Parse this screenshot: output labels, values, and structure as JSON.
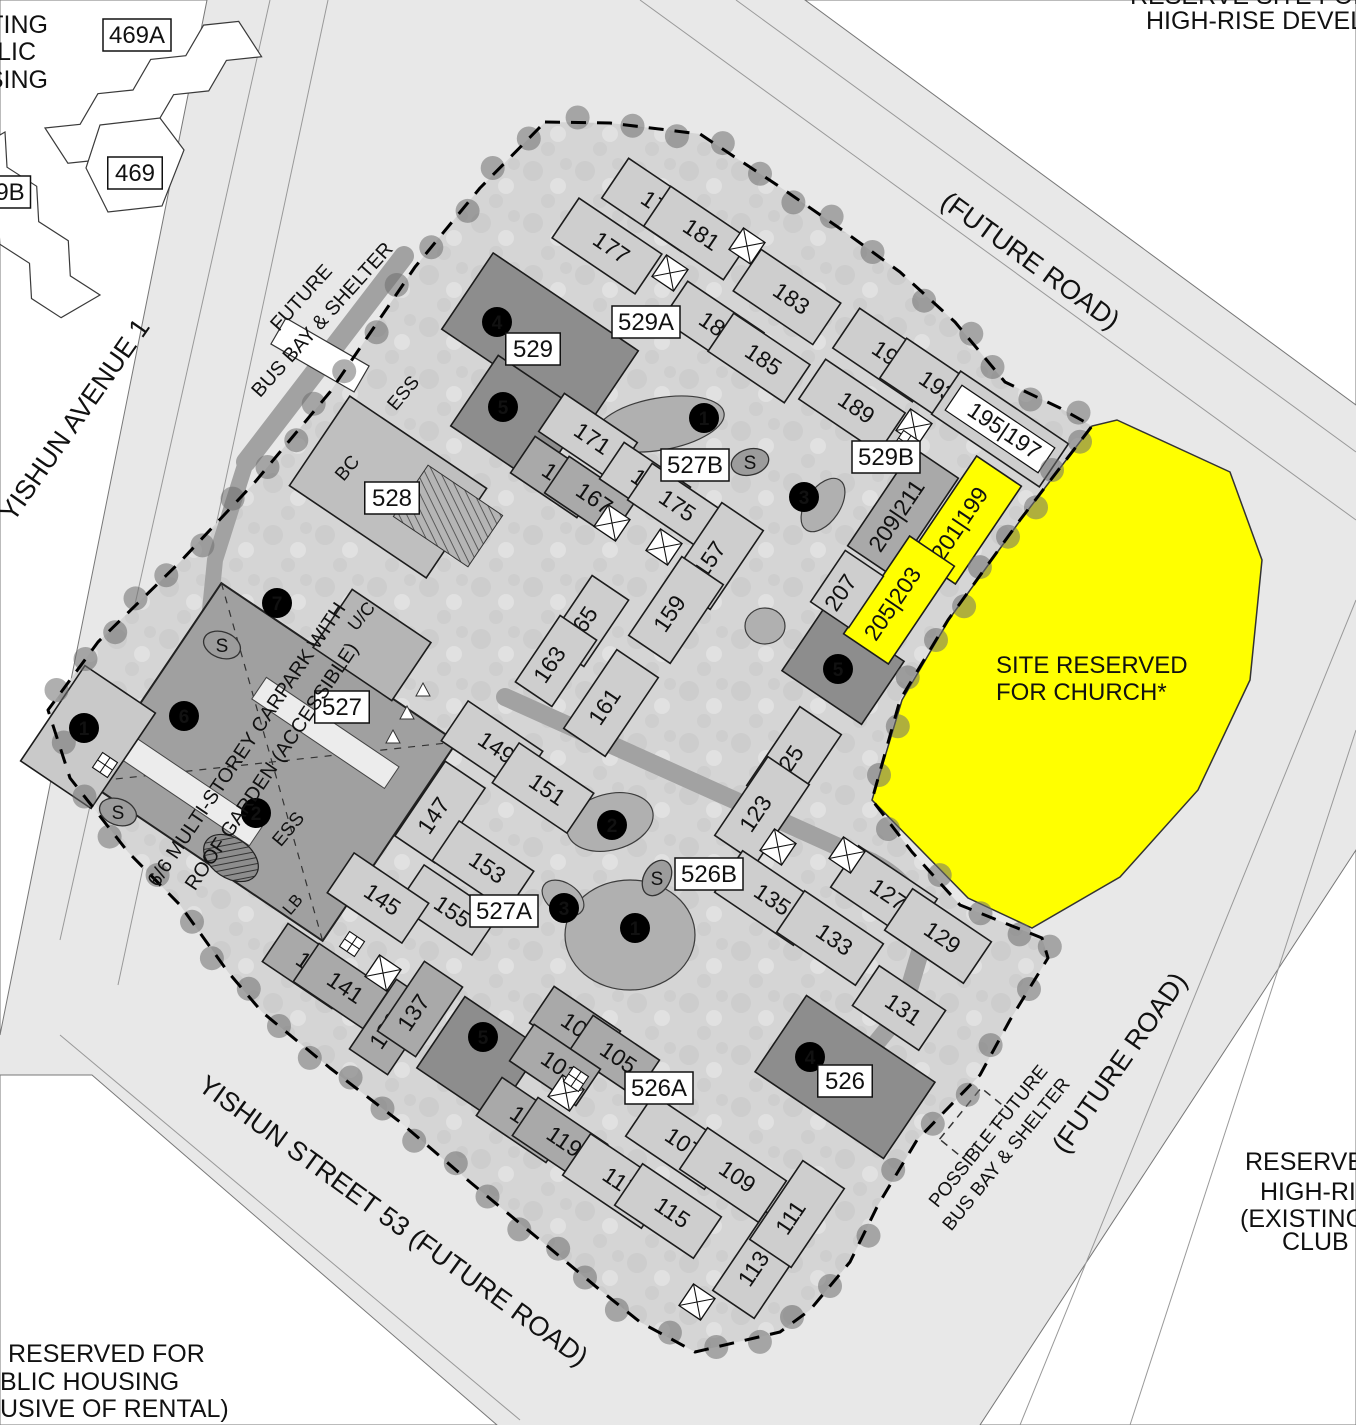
{
  "map": {
    "corner_texts": {
      "top_left_lines": [
        "TING",
        "LIC",
        "SING"
      ],
      "top_right_line1": "RESERVE SITE FOR",
      "top_right_line2": "HIGH-RISE DEVELO",
      "bottom_left_lines": [
        "RESERVED FOR",
        "BLIC HOUSING",
        "USIVE OF RENTAL)"
      ],
      "bottom_right_lines": [
        "RESERVE",
        "HIGH-RIS",
        "(EXISTING",
        "CLUB G"
      ]
    },
    "church": {
      "line1": "SITE RESERVED",
      "line2": "FOR CHURCH*"
    },
    "colors": {
      "road": "#e8e8e8",
      "site": "#d5d5d5",
      "inner_road": "#a2a2a2",
      "building_light": "#cecece",
      "building_mid": "#a9a9a9",
      "building_dark": "#8d8d8d",
      "carpark": "#a0a0a0",
      "block528": "#bfbfbf",
      "uc": "#b5b5b5",
      "yellow": "#ffff00",
      "tree": "rgba(110,110,110,0.55)",
      "grass": "#b0b0b0"
    },
    "road_labels": [
      {
        "text": "YISHUN AVENUE 1",
        "x": 82,
        "y": 425,
        "rot": -55,
        "size": 27
      },
      {
        "text": "(FUTURE ROAD)",
        "x": 1025,
        "y": 268,
        "rot": 36,
        "size": 27
      },
      {
        "text": "(FUTURE ROAD)",
        "x": 1127,
        "y": 1068,
        "rot": -55,
        "size": 27
      },
      {
        "text": "YISHUN STREET 53 (FUTURE ROAD)",
        "x": 388,
        "y": 1228,
        "rot": 36,
        "size": 27
      },
      {
        "text": "FUTURE",
        "x": 306,
        "y": 302,
        "rot": -48,
        "size": 20
      },
      {
        "text": "BUS BAY & SHELTER",
        "x": 327,
        "y": 324,
        "rot": -48,
        "size": 20
      },
      {
        "text": "POSSIBLE FUTURE",
        "x": 993,
        "y": 1140,
        "rot": -51,
        "size": 19
      },
      {
        "text": "BUS BAY & SHELTER",
        "x": 1011,
        "y": 1158,
        "rot": -51,
        "size": 19
      }
    ],
    "site_texts": [
      {
        "text": "6/6 MULTI-STOREY CARPARK WITH",
        "x": 252,
        "y": 748,
        "rot": -56,
        "size": 20
      },
      {
        "text": "ROOF GARDEN (ACCESSIBLE)",
        "x": 277,
        "y": 770,
        "rot": -56,
        "size": 20
      },
      {
        "text": "ESS",
        "x": 408,
        "y": 397,
        "rot": -50,
        "size": 19
      },
      {
        "text": "ESS",
        "x": 293,
        "y": 833,
        "rot": -50,
        "size": 19
      },
      {
        "text": "BC",
        "x": 352,
        "y": 472,
        "rot": -50,
        "size": 19
      },
      {
        "text": "U/C",
        "x": 366,
        "y": 620,
        "rot": -50,
        "size": 18
      },
      {
        "text": "LB",
        "x": 297,
        "y": 908,
        "rot": -50,
        "size": 17
      }
    ],
    "boxed_labels": [
      {
        "text": "529A",
        "x": 646,
        "y": 322
      },
      {
        "text": "529B",
        "x": 886,
        "y": 457
      },
      {
        "text": "527B",
        "x": 695,
        "y": 465
      },
      {
        "text": "527A",
        "x": 504,
        "y": 911
      },
      {
        "text": "526A",
        "x": 659,
        "y": 1088
      },
      {
        "text": "526B",
        "x": 709,
        "y": 874
      },
      {
        "text": "527",
        "x": 342,
        "y": 707
      },
      {
        "text": "528",
        "x": 392,
        "y": 498
      },
      {
        "text": "529",
        "x": 533,
        "y": 349
      },
      {
        "text": "526",
        "x": 845,
        "y": 1081
      },
      {
        "text": "469A",
        "x": 137,
        "y": 35
      },
      {
        "text": "469",
        "x": 135,
        "y": 173
      },
      {
        "text": "9B",
        "x": 10,
        "y": 192
      }
    ],
    "buildings": [
      {
        "n": "177",
        "x": 607,
        "y": 246,
        "w": 100,
        "h": 48,
        "rot": 34,
        "fill": "light"
      },
      {
        "n": "179",
        "x": 655,
        "y": 205,
        "w": 96,
        "h": 48,
        "rot": 34,
        "fill": "light"
      },
      {
        "n": "181",
        "x": 697,
        "y": 233,
        "w": 96,
        "h": 48,
        "rot": 34,
        "fill": "light"
      },
      {
        "n": "183",
        "x": 787,
        "y": 297,
        "w": 96,
        "h": 50,
        "rot": 34,
        "fill": "light"
      },
      {
        "n": "187",
        "x": 713,
        "y": 326,
        "w": 92,
        "h": 46,
        "rot": 34,
        "fill": "light"
      },
      {
        "n": "185",
        "x": 759,
        "y": 358,
        "w": 92,
        "h": 46,
        "rot": 34,
        "fill": "light"
      },
      {
        "n": "189",
        "x": 852,
        "y": 406,
        "w": 96,
        "h": 48,
        "rot": 34,
        "fill": "light"
      },
      {
        "n": "191",
        "x": 886,
        "y": 355,
        "w": 96,
        "h": 48,
        "rot": 34,
        "fill": "light"
      },
      {
        "n": "193",
        "x": 933,
        "y": 385,
        "w": 96,
        "h": 48,
        "rot": 34,
        "fill": "light"
      },
      {
        "n": "195|197",
        "x": 1000,
        "y": 429,
        "w": 130,
        "h": 52,
        "rot": 34,
        "fill": "light",
        "boxed": true
      },
      {
        "n": "209|211",
        "x": 903,
        "y": 512,
        "w": 118,
        "h": 54,
        "rot": -56,
        "fill": "mid"
      },
      {
        "n": "201|199",
        "x": 966,
        "y": 520,
        "w": 118,
        "h": 54,
        "rot": -56,
        "fill": "yellow"
      },
      {
        "n": "205|203",
        "x": 899,
        "y": 600,
        "w": 118,
        "h": 54,
        "rot": -56,
        "fill": "yellow"
      },
      {
        "n": "207",
        "x": 847,
        "y": 589,
        "w": 62,
        "h": 46,
        "rot": -56,
        "fill": "light"
      },
      {
        "n": "171",
        "x": 588,
        "y": 437,
        "w": 88,
        "h": 46,
        "rot": 34,
        "fill": "light"
      },
      {
        "n": "169",
        "x": 556,
        "y": 477,
        "w": 80,
        "h": 44,
        "rot": 34,
        "fill": "mid"
      },
      {
        "n": "167",
        "x": 590,
        "y": 497,
        "w": 80,
        "h": 44,
        "rot": 34,
        "fill": "mid"
      },
      {
        "n": "173",
        "x": 645,
        "y": 483,
        "w": 80,
        "h": 44,
        "rot": 34,
        "fill": "light"
      },
      {
        "n": "175",
        "x": 673,
        "y": 504,
        "w": 80,
        "h": 44,
        "rot": 34,
        "fill": "light"
      },
      {
        "n": "157",
        "x": 716,
        "y": 556,
        "w": 95,
        "h": 50,
        "rot": -56,
        "fill": "light"
      },
      {
        "n": "159",
        "x": 676,
        "y": 610,
        "w": 95,
        "h": 50,
        "rot": -56,
        "fill": "light"
      },
      {
        "n": "165",
        "x": 588,
        "y": 621,
        "w": 80,
        "h": 44,
        "rot": -56,
        "fill": "light"
      },
      {
        "n": "163",
        "x": 556,
        "y": 661,
        "w": 80,
        "h": 44,
        "rot": -56,
        "fill": "light"
      },
      {
        "n": "161",
        "x": 611,
        "y": 703,
        "w": 95,
        "h": 50,
        "rot": -56,
        "fill": "light"
      },
      {
        "n": "149",
        "x": 492,
        "y": 746,
        "w": 90,
        "h": 48,
        "rot": 34,
        "fill": "light"
      },
      {
        "n": "151",
        "x": 543,
        "y": 788,
        "w": 90,
        "h": 48,
        "rot": 34,
        "fill": "light"
      },
      {
        "n": "147",
        "x": 440,
        "y": 812,
        "w": 90,
        "h": 48,
        "rot": -56,
        "fill": "light"
      },
      {
        "n": "153",
        "x": 483,
        "y": 866,
        "w": 90,
        "h": 48,
        "rot": 34,
        "fill": "light"
      },
      {
        "n": "155",
        "x": 448,
        "y": 910,
        "w": 90,
        "h": 48,
        "rot": 34,
        "fill": "light"
      },
      {
        "n": "145",
        "x": 378,
        "y": 898,
        "w": 90,
        "h": 48,
        "rot": 34,
        "fill": "light"
      },
      {
        "n": "143",
        "x": 310,
        "y": 966,
        "w": 84,
        "h": 46,
        "rot": 34,
        "fill": "mid"
      },
      {
        "n": "141",
        "x": 341,
        "y": 986,
        "w": 84,
        "h": 46,
        "rot": 34,
        "fill": "mid"
      },
      {
        "n": "139",
        "x": 392,
        "y": 1027,
        "w": 84,
        "h": 46,
        "rot": -56,
        "fill": "mid"
      },
      {
        "n": "137",
        "x": 420,
        "y": 1009,
        "w": 84,
        "h": 46,
        "rot": -56,
        "fill": "mid"
      },
      {
        "n": "125",
        "x": 794,
        "y": 760,
        "w": 95,
        "h": 50,
        "rot": -56,
        "fill": "light"
      },
      {
        "n": "123",
        "x": 762,
        "y": 810,
        "w": 95,
        "h": 50,
        "rot": -56,
        "fill": "light"
      },
      {
        "n": "135",
        "x": 768,
        "y": 898,
        "w": 95,
        "h": 50,
        "rot": 34,
        "fill": "light"
      },
      {
        "n": "133",
        "x": 830,
        "y": 938,
        "w": 95,
        "h": 50,
        "rot": 34,
        "fill": "light"
      },
      {
        "n": "127",
        "x": 884,
        "y": 893,
        "w": 95,
        "h": 50,
        "rot": 34,
        "fill": "light"
      },
      {
        "n": "129",
        "x": 938,
        "y": 936,
        "w": 95,
        "h": 50,
        "rot": 34,
        "fill": "light"
      },
      {
        "n": "131",
        "x": 899,
        "y": 1008,
        "w": 80,
        "h": 48,
        "rot": 34,
        "fill": "light"
      },
      {
        "n": "103",
        "x": 575,
        "y": 1027,
        "w": 80,
        "h": 44,
        "rot": 34,
        "fill": "mid"
      },
      {
        "n": "105",
        "x": 614,
        "y": 1056,
        "w": 80,
        "h": 44,
        "rot": 34,
        "fill": "mid"
      },
      {
        "n": "101",
        "x": 555,
        "y": 1065,
        "w": 80,
        "h": 44,
        "rot": 34,
        "fill": "mid"
      },
      {
        "n": "121",
        "x": 524,
        "y": 1120,
        "w": 84,
        "h": 46,
        "rot": 34,
        "fill": "mid"
      },
      {
        "n": "119",
        "x": 560,
        "y": 1140,
        "w": 84,
        "h": 46,
        "rot": 34,
        "fill": "mid"
      },
      {
        "n": "117",
        "x": 616,
        "y": 1181,
        "w": 95,
        "h": 50,
        "rot": 34,
        "fill": "light"
      },
      {
        "n": "115",
        "x": 668,
        "y": 1211,
        "w": 95,
        "h": 50,
        "rot": 34,
        "fill": "light"
      },
      {
        "n": "107",
        "x": 679,
        "y": 1142,
        "w": 95,
        "h": 50,
        "rot": 34,
        "fill": "light"
      },
      {
        "n": "109",
        "x": 733,
        "y": 1175,
        "w": 95,
        "h": 50,
        "rot": 34,
        "fill": "light"
      },
      {
        "n": "113",
        "x": 760,
        "y": 1265,
        "w": 95,
        "h": 50,
        "rot": -56,
        "fill": "light"
      },
      {
        "n": "111",
        "x": 797,
        "y": 1214,
        "w": 95,
        "h": 50,
        "rot": -56,
        "fill": "light"
      }
    ],
    "numbered_circles": [
      {
        "n": "1",
        "x": 704,
        "y": 418
      },
      {
        "n": "1",
        "x": 635,
        "y": 928
      },
      {
        "n": "1",
        "x": 84,
        "y": 728
      },
      {
        "n": "2",
        "x": 612,
        "y": 825
      },
      {
        "n": "2",
        "x": 256,
        "y": 813
      },
      {
        "n": "3",
        "x": 804,
        "y": 497
      },
      {
        "n": "3",
        "x": 564,
        "y": 908
      },
      {
        "n": "4",
        "x": 497,
        "y": 322
      },
      {
        "n": "4",
        "x": 810,
        "y": 1057
      },
      {
        "n": "5",
        "x": 503,
        "y": 407
      },
      {
        "n": "5",
        "x": 838,
        "y": 669
      },
      {
        "n": "5",
        "x": 483,
        "y": 1037
      },
      {
        "n": "6",
        "x": 184,
        "y": 716
      },
      {
        "n": "7",
        "x": 277,
        "y": 603
      }
    ],
    "s_markers": [
      {
        "x": 750,
        "y": 462,
        "rot": -15
      },
      {
        "x": 657,
        "y": 878,
        "rot": -60
      },
      {
        "x": 222,
        "y": 645,
        "rot": 20
      },
      {
        "x": 118,
        "y": 812,
        "rot": 20
      }
    ]
  }
}
